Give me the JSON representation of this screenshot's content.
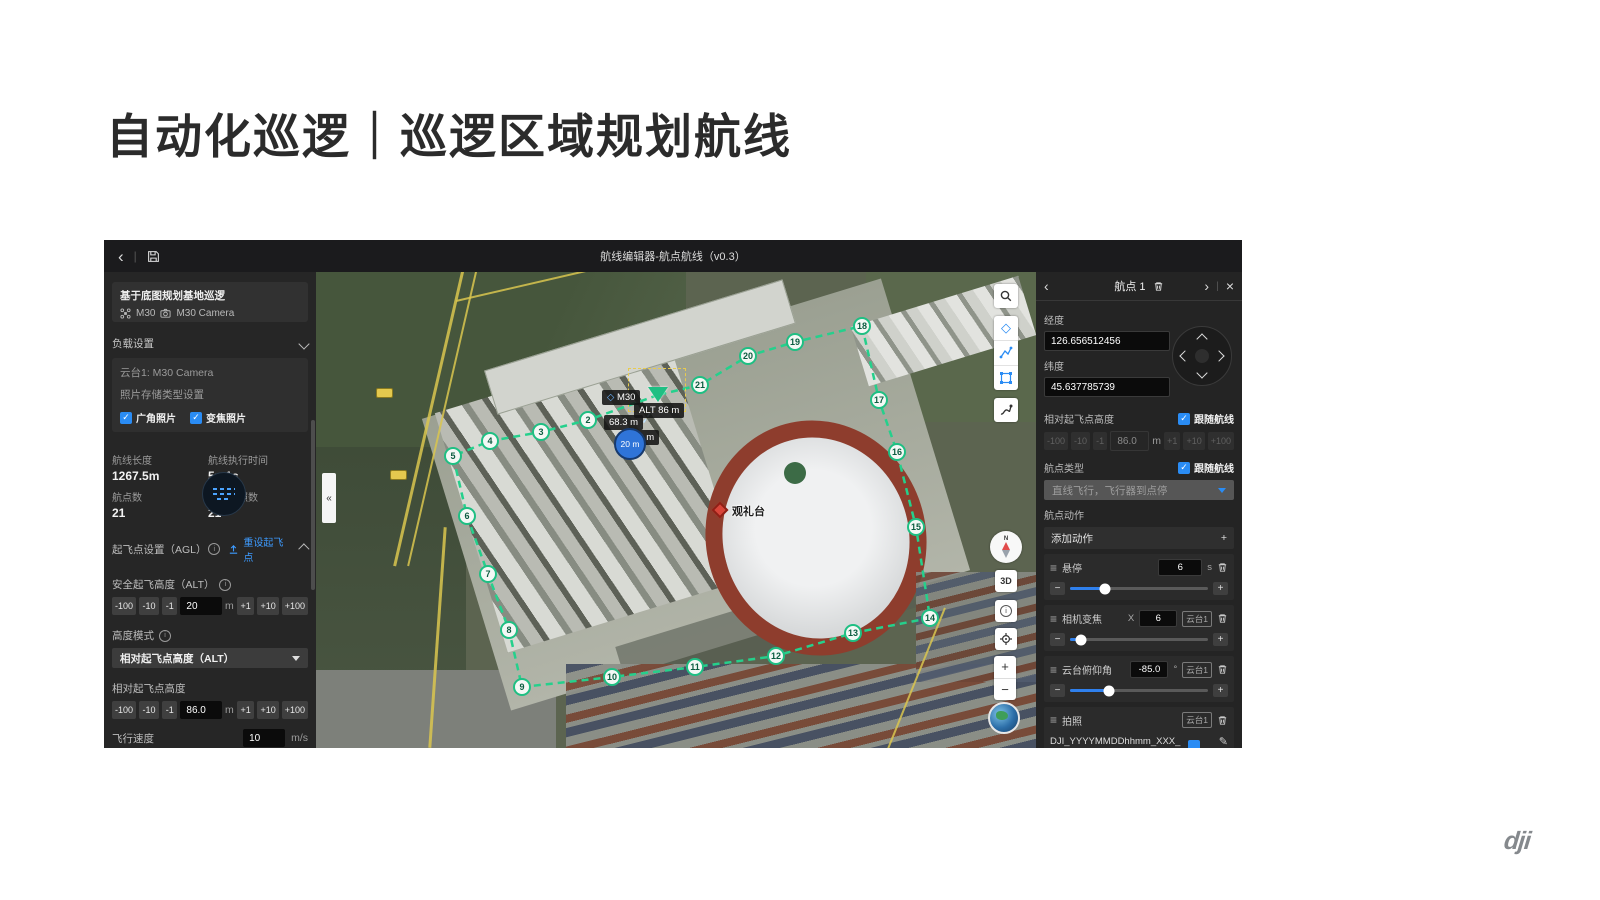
{
  "slide": {
    "title": "自动化巡逻｜巡逻区域规划航线",
    "brand": "dji"
  },
  "icons": {
    "back": "‹",
    "next": "›",
    "close": "×",
    "collapse": "«",
    "plus": "+",
    "minus": "−",
    "drag": "≡",
    "edit": "✎",
    "check": "✓",
    "diamond": "◇",
    "sep": "|"
  },
  "stepper": {
    "m100": "-100",
    "m10": "-10",
    "m1": "-1",
    "p1": "+1",
    "p10": "+10",
    "p100": "+100",
    "unit_m": "m"
  },
  "app": {
    "topbar": {
      "title": "航线编辑器-航点航线（v0.3）"
    },
    "sidebar": {
      "mission_name": "基于底图规划基地巡逻",
      "drone": "M30",
      "camera": "M30 Camera",
      "payload_header": "负载设置",
      "gimbal": "云台1: M30 Camera",
      "storage_label": "照片存储类型设置",
      "photo_wide": "广角照片",
      "photo_zoom": "变焦照片",
      "stats": {
        "len_label": "航线长度",
        "len": "1267.5m",
        "time_label": "航线执行时间",
        "time": "5m1s",
        "wp_label": "航点数",
        "wp": "21",
        "photo_label": "预计拍照数",
        "photo": "21"
      },
      "takeoff_header": "起飞点设置（AGL）",
      "reset_takeoff": "重设起飞点",
      "safe_alt_label": "安全起飞高度（ALT）",
      "safe_alt": "20",
      "alt_mode_label": "高度模式",
      "alt_mode": "相对起飞点高度（ALT）",
      "rel_alt_label": "相对起飞点高度",
      "rel_alt": "86.0",
      "speed_label": "飞行速度",
      "speed": "10",
      "speed_unit": "m/s",
      "speed_pct": 62,
      "yaw_label": "飞行器偏航角模式"
    },
    "map": {
      "selected": {
        "n": 1,
        "x": 342,
        "y": 123
      },
      "waypoints": [
        {
          "n": 2,
          "x": 272,
          "y": 148
        },
        {
          "n": 3,
          "x": 225,
          "y": 160
        },
        {
          "n": 4,
          "x": 174,
          "y": 169
        },
        {
          "n": 5,
          "x": 137,
          "y": 184
        },
        {
          "n": 6,
          "x": 151,
          "y": 244
        },
        {
          "n": 7,
          "x": 172,
          "y": 302
        },
        {
          "n": 8,
          "x": 193,
          "y": 358
        },
        {
          "n": 9,
          "x": 206,
          "y": 415
        },
        {
          "n": 10,
          "x": 296,
          "y": 405
        },
        {
          "n": 11,
          "x": 379,
          "y": 395
        },
        {
          "n": 12,
          "x": 460,
          "y": 384
        },
        {
          "n": 13,
          "x": 537,
          "y": 361
        },
        {
          "n": 14,
          "x": 614,
          "y": 346
        },
        {
          "n": 15,
          "x": 600,
          "y": 255
        },
        {
          "n": 16,
          "x": 581,
          "y": 180
        },
        {
          "n": 17,
          "x": 563,
          "y": 128
        },
        {
          "n": 18,
          "x": 546,
          "y": 54
        },
        {
          "n": 19,
          "x": 479,
          "y": 70
        },
        {
          "n": 20,
          "x": 432,
          "y": 84
        },
        {
          "n": 21,
          "x": 384,
          "y": 113
        }
      ],
      "m30": "M30",
      "alt_badge": "ALT 86 m",
      "dist1": "68.3 m",
      "dist2": "79 m",
      "takeoff_label": "20 m",
      "poi": "观礼台",
      "compass_n": "N",
      "btn_3d": "3D"
    },
    "panel": {
      "title": "航点 1",
      "lon_label": "经度",
      "lon": "126.656512456",
      "lat_label": "纬度",
      "lat": "45.637785739",
      "rel_alt_label": "相对起飞点高度",
      "follow": "跟随航线",
      "rel_alt": "86.0",
      "type_label": "航点类型",
      "type_value": "直线飞行，飞行器到点停",
      "actions_header": "航点动作",
      "add_action": "添加动作",
      "actions": [
        {
          "name": "悬停",
          "value": "6",
          "unit": "s",
          "pct": 25
        },
        {
          "name": "相机变焦",
          "prefix": "X",
          "value": "6",
          "badge": "云台1",
          "pct": 8
        },
        {
          "name": "云台俯仰角",
          "value": "-85.0",
          "unit": "°",
          "badge": "云台1",
          "pct": 28
        },
        {
          "name": "拍照",
          "badge": "云台1",
          "filename": "DJI_YYYYMMDDhhmm_XXX_"
        }
      ]
    }
  }
}
